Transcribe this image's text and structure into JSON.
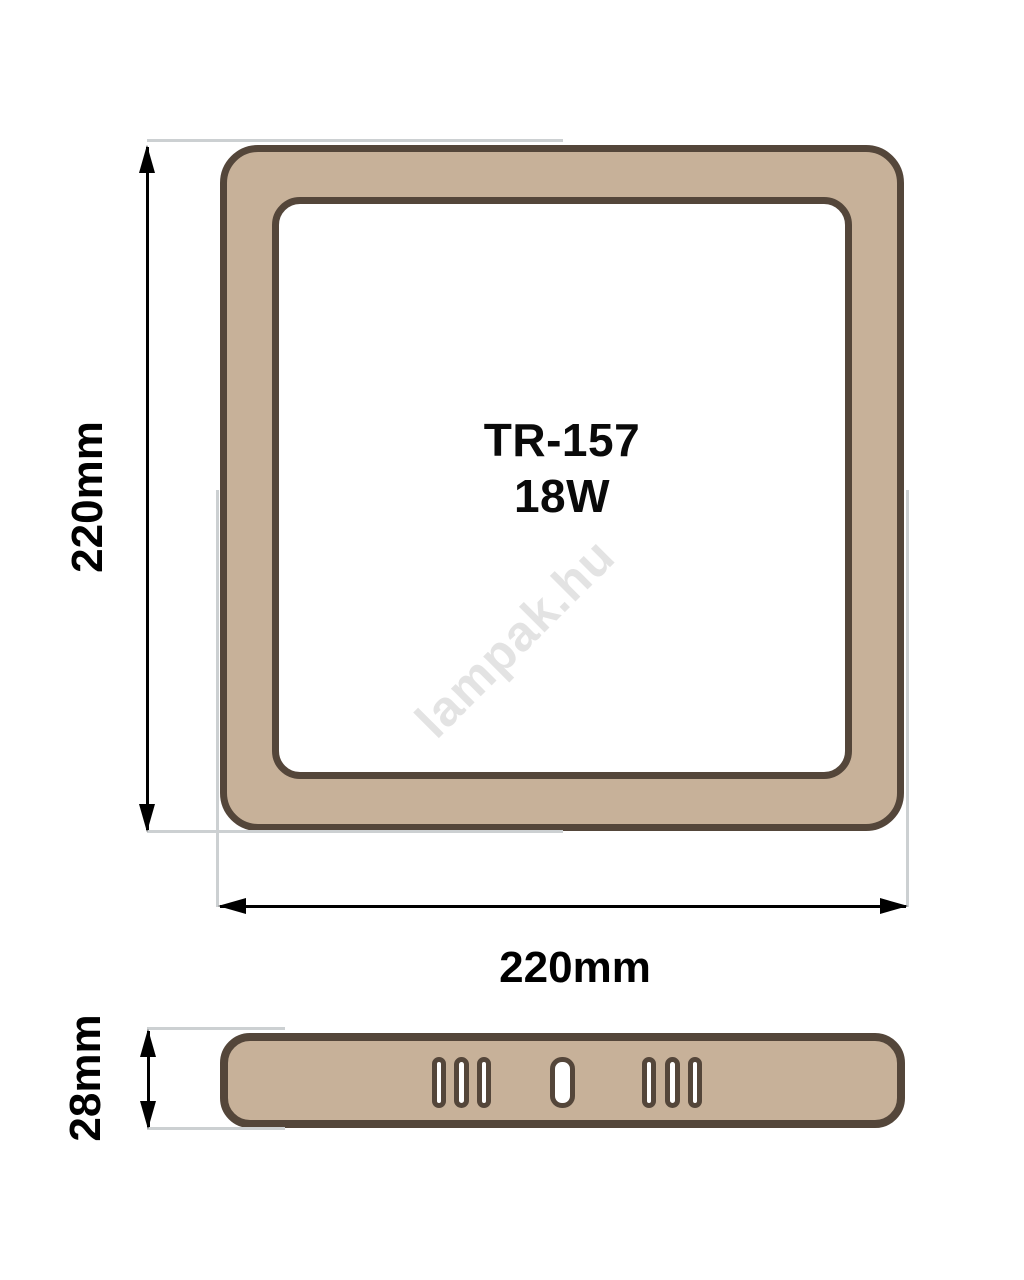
{
  "product": {
    "model": "TR-157",
    "wattage": "18W"
  },
  "watermark_text": "lampak.hu",
  "dimension_labels": {
    "top_view_height": "220mm",
    "top_view_width": "220mm",
    "side_view_height": "28mm"
  },
  "views": {
    "top_view": "square panel, rounded corners, tan frame with white center",
    "side_view": "thin profile with 7 vent slots"
  },
  "colors": {
    "panel_fill": "#c7b199",
    "panel_outline": "#54463a",
    "extension_line": "#ccd0d2",
    "dimension_line": "#000000",
    "watermark": "#e3e3e3",
    "label_text": "#000000"
  }
}
